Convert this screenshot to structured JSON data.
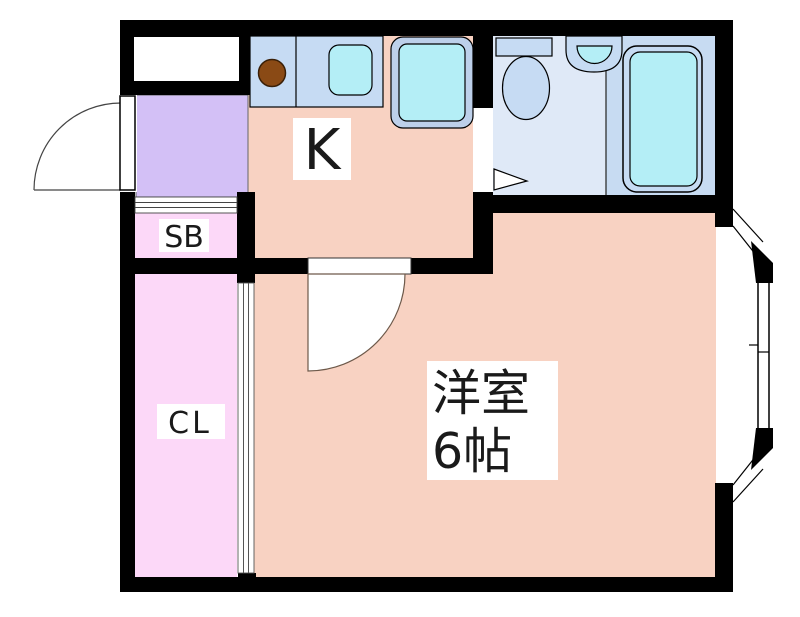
{
  "plan": {
    "labels": {
      "kitchen": "K",
      "shoe_box": "SB",
      "closet": "CL",
      "main_room_name": "洋室",
      "main_room_size": "6帖"
    },
    "colors": {
      "wall": "#000000",
      "floor_salmon": "#f8d2c2",
      "entry_purple": "#d3c0f6",
      "storage_pink": "#fcd8f8",
      "fixture_blue": "#c6dbf3",
      "toilet_floor": "#dfe9f7",
      "bath_floor": "#c7dbf2",
      "water_cyan": "#b4eef6",
      "appliance_rim": "#bdd0ea",
      "burner_brown": "#8a4a15",
      "label_text": "#1a1a1a",
      "door_arc": "#6d594a",
      "thin_line": "#444444"
    }
  }
}
